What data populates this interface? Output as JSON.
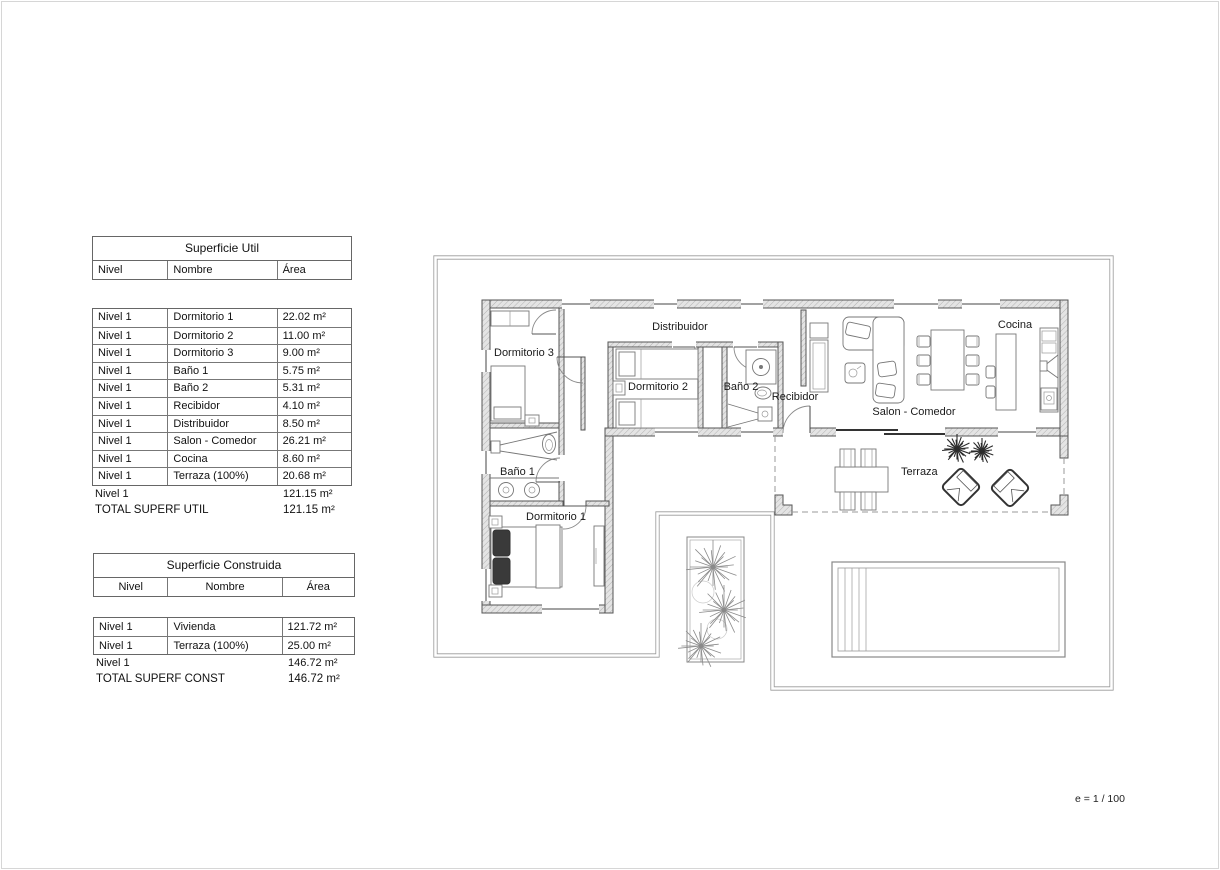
{
  "page": {
    "scale_label": "e = 1 / 100"
  },
  "tables": {
    "util": {
      "title": "Superficie Util",
      "columns": {
        "nivel": "Nivel",
        "nombre": "Nombre",
        "area": "Área"
      },
      "rows": [
        {
          "nivel": "Nivel 1",
          "nombre": "Dormitorio 1",
          "area": "22.02 m²"
        },
        {
          "nivel": "Nivel 1",
          "nombre": "Dormitorio 2",
          "area": "11.00 m²"
        },
        {
          "nivel": "Nivel 1",
          "nombre": "Dormitorio 3",
          "area": "9.00 m²"
        },
        {
          "nivel": "Nivel 1",
          "nombre": "Baño 1",
          "area": "5.75 m²"
        },
        {
          "nivel": "Nivel 1",
          "nombre": "Baño 2",
          "area": "5.31 m²"
        },
        {
          "nivel": "Nivel 1",
          "nombre": "Recibidor",
          "area": "4.10 m²"
        },
        {
          "nivel": "Nivel 1",
          "nombre": "Distribuidor",
          "area": "8.50 m²"
        },
        {
          "nivel": "Nivel 1",
          "nombre": "Salon - Comedor",
          "area": "26.21 m²"
        },
        {
          "nivel": "Nivel 1",
          "nombre": "Cocina",
          "area": "8.60 m²"
        },
        {
          "nivel": "Nivel 1",
          "nombre": "Terraza (100%)",
          "area": "20.68 m²"
        }
      ],
      "subtotal": {
        "nivel": "Nivel 1",
        "area": "121.15 m²"
      },
      "total": {
        "label": "TOTAL SUPERF UTIL",
        "area": "121.15 m²"
      }
    },
    "construida": {
      "title": "Superficie Construida",
      "columns": {
        "nivel": "Nivel",
        "nombre": "Nombre",
        "area": "Área"
      },
      "rows": [
        {
          "nivel": "Nivel 1",
          "nombre": "Vivienda",
          "area": "121.72 m²"
        },
        {
          "nivel": "Nivel 1",
          "nombre": "Terraza (100%)",
          "area": "25.00 m²"
        }
      ],
      "subtotal": {
        "nivel": "Nivel 1",
        "area": "146.72 m²"
      },
      "total": {
        "label": "TOTAL SUPERF CONST",
        "area": "146.72 m²"
      }
    }
  },
  "plan": {
    "rooms": {
      "dormitorio3": "Dormitorio 3",
      "distribuidor": "Distribuidor",
      "dormitorio2": "Dormitorio 2",
      "bano2": "Baño 2",
      "recibidor": "Recibidor",
      "salon": "Salon - Comedor",
      "cocina": "Cocina",
      "bano1": "Baño 1",
      "dormitorio1": "Dormitorio 1",
      "terraza": "Terraza"
    }
  }
}
